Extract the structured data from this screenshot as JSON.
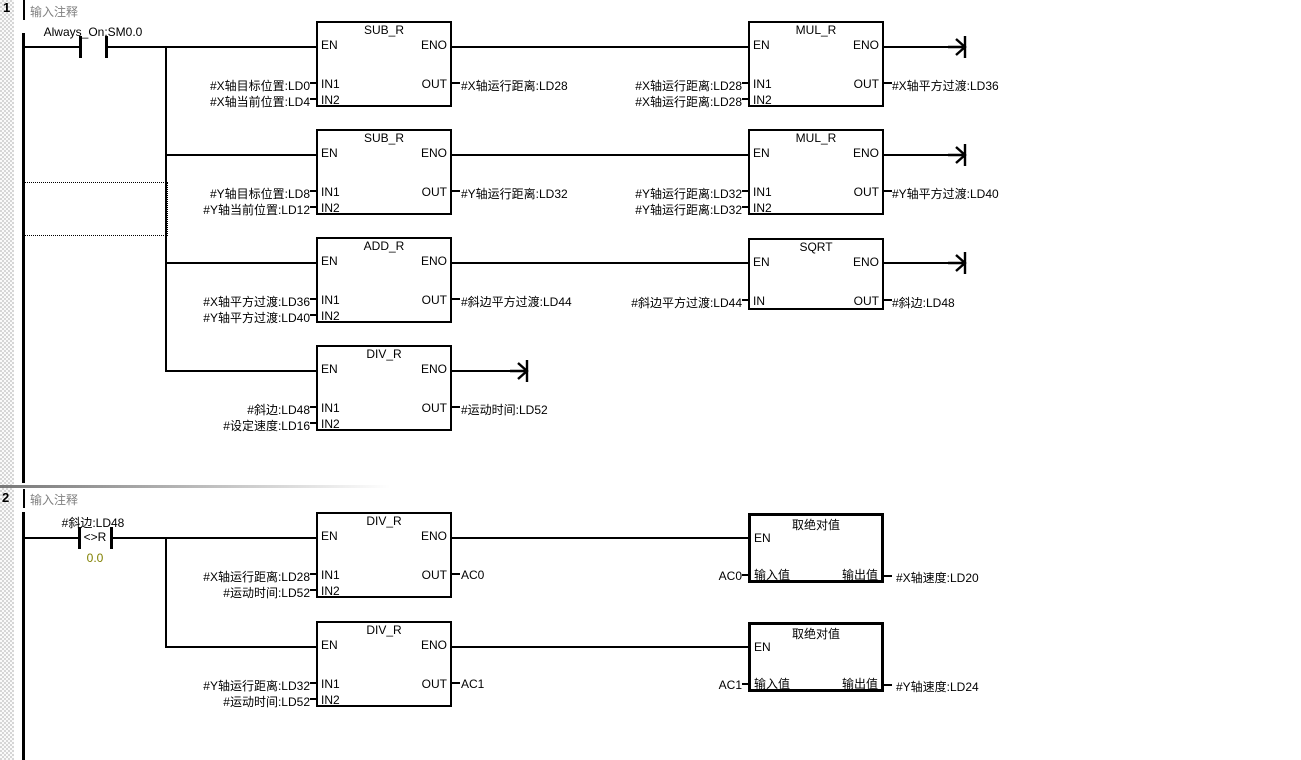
{
  "ports": {
    "en": "EN",
    "eno": "ENO",
    "in1": "IN1",
    "in2": "IN2",
    "in": "IN",
    "out": "OUT",
    "value_in": "输入值",
    "value_out": "输出值"
  },
  "colors": {
    "comment_text": "#808080",
    "compare_value_text": "#808000",
    "wire": "#000000",
    "background": "#ffffff"
  },
  "networks": [
    {
      "number": "1",
      "comment": "输入注释",
      "contact": {
        "label": "Always_On:SM0.0"
      },
      "blocks": {
        "sub_x": {
          "title": "SUB_R",
          "in1_operand": "#X轴目标位置:LD0",
          "in2_operand": "#X轴当前位置:LD4",
          "out_operand": "#X轴运行距离:LD28"
        },
        "mul_x": {
          "title": "MUL_R",
          "in1_operand": "#X轴运行距离:LD28",
          "in2_operand": "#X轴运行距离:LD28",
          "out_operand": "#X轴平方过渡:LD36"
        },
        "sub_y": {
          "title": "SUB_R",
          "in1_operand": "#Y轴目标位置:LD8",
          "in2_operand": "#Y轴当前位置:LD12",
          "out_operand": "#Y轴运行距离:LD32"
        },
        "mul_y": {
          "title": "MUL_R",
          "in1_operand": "#Y轴运行距离:LD32",
          "in2_operand": "#Y轴运行距离:LD32",
          "out_operand": "#Y轴平方过渡:LD40"
        },
        "add": {
          "title": "ADD_R",
          "in1_operand": "#X轴平方过渡:LD36",
          "in2_operand": "#Y轴平方过渡:LD40",
          "out_operand": "#斜边平方过渡:LD44"
        },
        "sqrt": {
          "title": "SQRT",
          "in_operand": "#斜边平方过渡:LD44",
          "out_operand": "#斜边:LD48"
        },
        "div_time": {
          "title": "DIV_R",
          "in1_operand": "#斜边:LD48",
          "in2_operand": "#设定速度:LD16",
          "out_operand": "#运动时间:LD52"
        }
      }
    },
    {
      "number": "2",
      "comment": "输入注释",
      "contact": {
        "label": "#斜边:LD48",
        "operator": "<>R",
        "compare_value": "0.0"
      },
      "blocks": {
        "div_vx": {
          "title": "DIV_R",
          "in1_operand": "#X轴运行距离:LD28",
          "in2_operand": "#运动时间:LD52",
          "out_operand": "AC0"
        },
        "abs_x": {
          "title": "取绝对值",
          "in_operand": "AC0",
          "out_operand": "#X轴速度:LD20"
        },
        "div_vy": {
          "title": "DIV_R",
          "in1_operand": "#Y轴运行距离:LD32",
          "in2_operand": "#运动时间:LD52",
          "out_operand": "AC1"
        },
        "abs_y": {
          "title": "取绝对值",
          "in_operand": "AC1",
          "out_operand": "#Y轴速度:LD24"
        }
      }
    }
  ]
}
